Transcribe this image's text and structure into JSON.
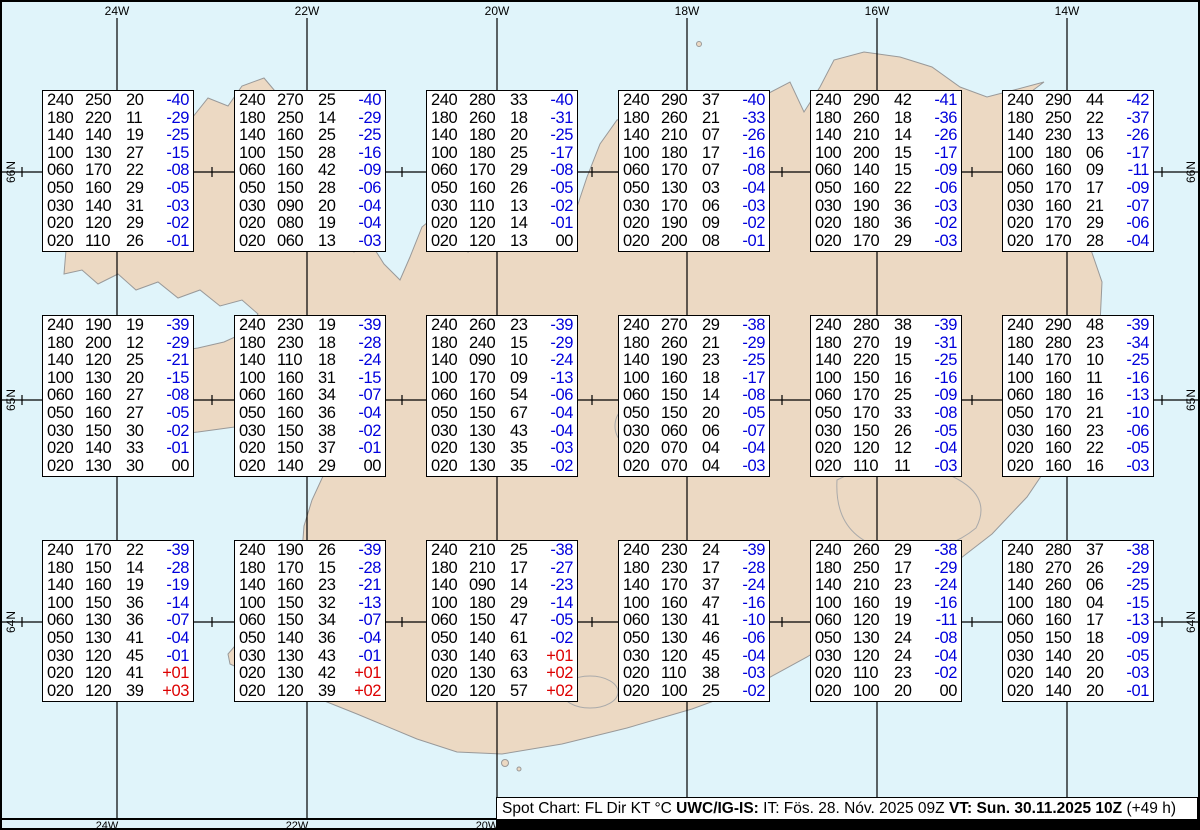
{
  "colors": {
    "sea": "#e0f4fa",
    "land": "#ecd9c3",
    "coast": "#999999",
    "grid": "#000000",
    "neg": "#0000dd",
    "pos": "#dd0000"
  },
  "map": {
    "top_longitude_labels": [
      "24W",
      "22W",
      "20W",
      "18W",
      "16W",
      "14W"
    ],
    "bottom_longitude_labels": [
      "24W",
      "22W",
      "20W"
    ],
    "latitude_labels": [
      "66N",
      "65N",
      "64N"
    ]
  },
  "status_bar": {
    "segments": [
      {
        "text": "Spot Chart: FL Dir KT °C ",
        "bold": false
      },
      {
        "text": "UWC/IG-IS:",
        "bold": true
      },
      {
        "text": " IT: Fös. 28. Nóv. 2025 09Z ",
        "bold": false
      },
      {
        "text": "VT: Sun. 30.11.2025 10Z",
        "bold": true
      },
      {
        "text": " (+49 h)",
        "bold": false
      }
    ]
  },
  "chart_data": {
    "type": "table",
    "columns": [
      "FL",
      "Dir",
      "KT",
      "TempC"
    ],
    "title": "Spot Chart: FL Dir KT °C",
    "stations": [
      {
        "row": 0,
        "col": 0,
        "rows": [
          [
            "240",
            "250",
            "20",
            "-40"
          ],
          [
            "180",
            "220",
            "11",
            "-29"
          ],
          [
            "140",
            "140",
            "19",
            "-25"
          ],
          [
            "100",
            "130",
            "27",
            "-15"
          ],
          [
            "060",
            "170",
            "22",
            "-08"
          ],
          [
            "050",
            "160",
            "29",
            "-05"
          ],
          [
            "030",
            "140",
            "31",
            "-03"
          ],
          [
            "020",
            "120",
            "29",
            "-02"
          ],
          [
            "020",
            "110",
            "26",
            "-01"
          ]
        ]
      },
      {
        "row": 0,
        "col": 1,
        "rows": [
          [
            "240",
            "270",
            "25",
            "-40"
          ],
          [
            "180",
            "250",
            "14",
            "-29"
          ],
          [
            "140",
            "160",
            "25",
            "-25"
          ],
          [
            "100",
            "150",
            "28",
            "-16"
          ],
          [
            "060",
            "160",
            "42",
            "-09"
          ],
          [
            "050",
            "150",
            "28",
            "-06"
          ],
          [
            "030",
            "090",
            "20",
            "-04"
          ],
          [
            "020",
            "080",
            "19",
            "-04"
          ],
          [
            "020",
            "060",
            "13",
            "-03"
          ]
        ]
      },
      {
        "row": 0,
        "col": 2,
        "rows": [
          [
            "240",
            "280",
            "33",
            "-40"
          ],
          [
            "180",
            "260",
            "18",
            "-31"
          ],
          [
            "140",
            "180",
            "20",
            "-25"
          ],
          [
            "100",
            "180",
            "25",
            "-17"
          ],
          [
            "060",
            "170",
            "29",
            "-08"
          ],
          [
            "050",
            "160",
            "26",
            "-05"
          ],
          [
            "030",
            "110",
            "13",
            "-02"
          ],
          [
            "020",
            "120",
            "14",
            "-01"
          ],
          [
            "020",
            "120",
            "13",
            "00"
          ]
        ]
      },
      {
        "row": 0,
        "col": 3,
        "rows": [
          [
            "240",
            "290",
            "37",
            "-40"
          ],
          [
            "180",
            "260",
            "21",
            "-33"
          ],
          [
            "140",
            "210",
            "07",
            "-26"
          ],
          [
            "100",
            "180",
            "17",
            "-16"
          ],
          [
            "060",
            "170",
            "07",
            "-08"
          ],
          [
            "050",
            "130",
            "03",
            "-04"
          ],
          [
            "030",
            "170",
            "06",
            "-03"
          ],
          [
            "020",
            "190",
            "09",
            "-02"
          ],
          [
            "020",
            "200",
            "08",
            "-01"
          ]
        ]
      },
      {
        "row": 0,
        "col": 4,
        "rows": [
          [
            "240",
            "290",
            "42",
            "-41"
          ],
          [
            "180",
            "260",
            "18",
            "-36"
          ],
          [
            "140",
            "210",
            "14",
            "-26"
          ],
          [
            "100",
            "200",
            "15",
            "-17"
          ],
          [
            "060",
            "140",
            "15",
            "-09"
          ],
          [
            "050",
            "160",
            "22",
            "-06"
          ],
          [
            "030",
            "190",
            "36",
            "-03"
          ],
          [
            "020",
            "180",
            "36",
            "-02"
          ],
          [
            "020",
            "170",
            "29",
            "-03"
          ]
        ]
      },
      {
        "row": 0,
        "col": 5,
        "rows": [
          [
            "240",
            "290",
            "44",
            "-42"
          ],
          [
            "180",
            "250",
            "22",
            "-37"
          ],
          [
            "140",
            "230",
            "13",
            "-26"
          ],
          [
            "100",
            "180",
            "06",
            "-17"
          ],
          [
            "060",
            "160",
            "09",
            "-11"
          ],
          [
            "050",
            "170",
            "17",
            "-09"
          ],
          [
            "030",
            "160",
            "21",
            "-07"
          ],
          [
            "020",
            "170",
            "29",
            "-06"
          ],
          [
            "020",
            "170",
            "28",
            "-04"
          ]
        ]
      },
      {
        "row": 1,
        "col": 0,
        "rows": [
          [
            "240",
            "190",
            "19",
            "-39"
          ],
          [
            "180",
            "200",
            "12",
            "-29"
          ],
          [
            "140",
            "120",
            "25",
            "-21"
          ],
          [
            "100",
            "130",
            "20",
            "-15"
          ],
          [
            "060",
            "160",
            "27",
            "-08"
          ],
          [
            "050",
            "160",
            "27",
            "-05"
          ],
          [
            "030",
            "150",
            "30",
            "-02"
          ],
          [
            "020",
            "140",
            "33",
            "-01"
          ],
          [
            "020",
            "130",
            "30",
            "00"
          ]
        ]
      },
      {
        "row": 1,
        "col": 1,
        "rows": [
          [
            "240",
            "230",
            "19",
            "-39"
          ],
          [
            "180",
            "230",
            "18",
            "-28"
          ],
          [
            "140",
            "110",
            "18",
            "-24"
          ],
          [
            "100",
            "160",
            "31",
            "-15"
          ],
          [
            "060",
            "160",
            "34",
            "-07"
          ],
          [
            "050",
            "160",
            "36",
            "-04"
          ],
          [
            "030",
            "150",
            "38",
            "-02"
          ],
          [
            "020",
            "150",
            "37",
            "-01"
          ],
          [
            "020",
            "140",
            "29",
            "00"
          ]
        ]
      },
      {
        "row": 1,
        "col": 2,
        "rows": [
          [
            "240",
            "260",
            "23",
            "-39"
          ],
          [
            "180",
            "240",
            "15",
            "-29"
          ],
          [
            "140",
            "090",
            "10",
            "-24"
          ],
          [
            "100",
            "170",
            "09",
            "-13"
          ],
          [
            "060",
            "160",
            "54",
            "-06"
          ],
          [
            "050",
            "150",
            "67",
            "-04"
          ],
          [
            "030",
            "130",
            "43",
            "-04"
          ],
          [
            "020",
            "130",
            "35",
            "-03"
          ],
          [
            "020",
            "130",
            "35",
            "-02"
          ]
        ]
      },
      {
        "row": 1,
        "col": 3,
        "rows": [
          [
            "240",
            "270",
            "29",
            "-38"
          ],
          [
            "180",
            "260",
            "21",
            "-29"
          ],
          [
            "140",
            "190",
            "23",
            "-25"
          ],
          [
            "100",
            "160",
            "18",
            "-17"
          ],
          [
            "060",
            "150",
            "14",
            "-08"
          ],
          [
            "050",
            "150",
            "20",
            "-05"
          ],
          [
            "030",
            "060",
            "06",
            "-07"
          ],
          [
            "020",
            "070",
            "04",
            "-04"
          ],
          [
            "020",
            "070",
            "04",
            "-03"
          ]
        ]
      },
      {
        "row": 1,
        "col": 4,
        "rows": [
          [
            "240",
            "280",
            "38",
            "-39"
          ],
          [
            "180",
            "270",
            "19",
            "-31"
          ],
          [
            "140",
            "220",
            "15",
            "-25"
          ],
          [
            "100",
            "150",
            "16",
            "-16"
          ],
          [
            "060",
            "170",
            "25",
            "-09"
          ],
          [
            "050",
            "170",
            "33",
            "-08"
          ],
          [
            "030",
            "150",
            "26",
            "-05"
          ],
          [
            "020",
            "120",
            "12",
            "-04"
          ],
          [
            "020",
            "110",
            "11",
            "-03"
          ]
        ]
      },
      {
        "row": 1,
        "col": 5,
        "rows": [
          [
            "240",
            "290",
            "48",
            "-39"
          ],
          [
            "180",
            "280",
            "23",
            "-34"
          ],
          [
            "140",
            "170",
            "10",
            "-25"
          ],
          [
            "100",
            "160",
            "11",
            "-16"
          ],
          [
            "060",
            "180",
            "16",
            "-13"
          ],
          [
            "050",
            "170",
            "21",
            "-10"
          ],
          [
            "030",
            "160",
            "23",
            "-06"
          ],
          [
            "020",
            "160",
            "22",
            "-05"
          ],
          [
            "020",
            "160",
            "16",
            "-03"
          ]
        ]
      },
      {
        "row": 2,
        "col": 0,
        "rows": [
          [
            "240",
            "170",
            "22",
            "-39"
          ],
          [
            "180",
            "150",
            "14",
            "-28"
          ],
          [
            "140",
            "160",
            "19",
            "-19"
          ],
          [
            "100",
            "150",
            "36",
            "-14"
          ],
          [
            "060",
            "130",
            "36",
            "-07"
          ],
          [
            "050",
            "130",
            "41",
            "-04"
          ],
          [
            "030",
            "120",
            "45",
            "-01"
          ],
          [
            "020",
            "120",
            "41",
            "+01"
          ],
          [
            "020",
            "120",
            "39",
            "+03"
          ]
        ]
      },
      {
        "row": 2,
        "col": 1,
        "rows": [
          [
            "240",
            "190",
            "26",
            "-39"
          ],
          [
            "180",
            "170",
            "15",
            "-28"
          ],
          [
            "140",
            "160",
            "23",
            "-21"
          ],
          [
            "100",
            "150",
            "32",
            "-13"
          ],
          [
            "060",
            "150",
            "34",
            "-07"
          ],
          [
            "050",
            "140",
            "36",
            "-04"
          ],
          [
            "030",
            "130",
            "43",
            "-01"
          ],
          [
            "020",
            "130",
            "42",
            "+01"
          ],
          [
            "020",
            "120",
            "39",
            "+02"
          ]
        ]
      },
      {
        "row": 2,
        "col": 2,
        "rows": [
          [
            "240",
            "210",
            "25",
            "-38"
          ],
          [
            "180",
            "210",
            "17",
            "-27"
          ],
          [
            "140",
            "090",
            "14",
            "-23"
          ],
          [
            "100",
            "180",
            "29",
            "-14"
          ],
          [
            "060",
            "150",
            "47",
            "-05"
          ],
          [
            "050",
            "140",
            "61",
            "-02"
          ],
          [
            "030",
            "140",
            "63",
            "+01"
          ],
          [
            "020",
            "130",
            "63",
            "+02"
          ],
          [
            "020",
            "120",
            "57",
            "+02"
          ]
        ]
      },
      {
        "row": 2,
        "col": 3,
        "rows": [
          [
            "240",
            "230",
            "24",
            "-39"
          ],
          [
            "180",
            "230",
            "17",
            "-28"
          ],
          [
            "140",
            "170",
            "37",
            "-24"
          ],
          [
            "100",
            "160",
            "47",
            "-16"
          ],
          [
            "060",
            "130",
            "41",
            "-10"
          ],
          [
            "050",
            "130",
            "46",
            "-06"
          ],
          [
            "030",
            "120",
            "45",
            "-04"
          ],
          [
            "020",
            "110",
            "38",
            "-03"
          ],
          [
            "020",
            "100",
            "25",
            "-02"
          ]
        ]
      },
      {
        "row": 2,
        "col": 4,
        "rows": [
          [
            "240",
            "260",
            "29",
            "-38"
          ],
          [
            "180",
            "250",
            "17",
            "-29"
          ],
          [
            "140",
            "210",
            "23",
            "-24"
          ],
          [
            "100",
            "160",
            "19",
            "-16"
          ],
          [
            "060",
            "120",
            "19",
            "-11"
          ],
          [
            "050",
            "130",
            "24",
            "-08"
          ],
          [
            "030",
            "120",
            "24",
            "-04"
          ],
          [
            "020",
            "110",
            "23",
            "-02"
          ],
          [
            "020",
            "100",
            "20",
            "00"
          ]
        ]
      },
      {
        "row": 2,
        "col": 5,
        "rows": [
          [
            "240",
            "280",
            "37",
            "-38"
          ],
          [
            "180",
            "270",
            "26",
            "-29"
          ],
          [
            "140",
            "260",
            "06",
            "-25"
          ],
          [
            "100",
            "180",
            "04",
            "-15"
          ],
          [
            "060",
            "160",
            "17",
            "-13"
          ],
          [
            "050",
            "150",
            "18",
            "-09"
          ],
          [
            "030",
            "140",
            "20",
            "-05"
          ],
          [
            "020",
            "140",
            "20",
            "-03"
          ],
          [
            "020",
            "140",
            "20",
            "-01"
          ]
        ]
      }
    ]
  }
}
